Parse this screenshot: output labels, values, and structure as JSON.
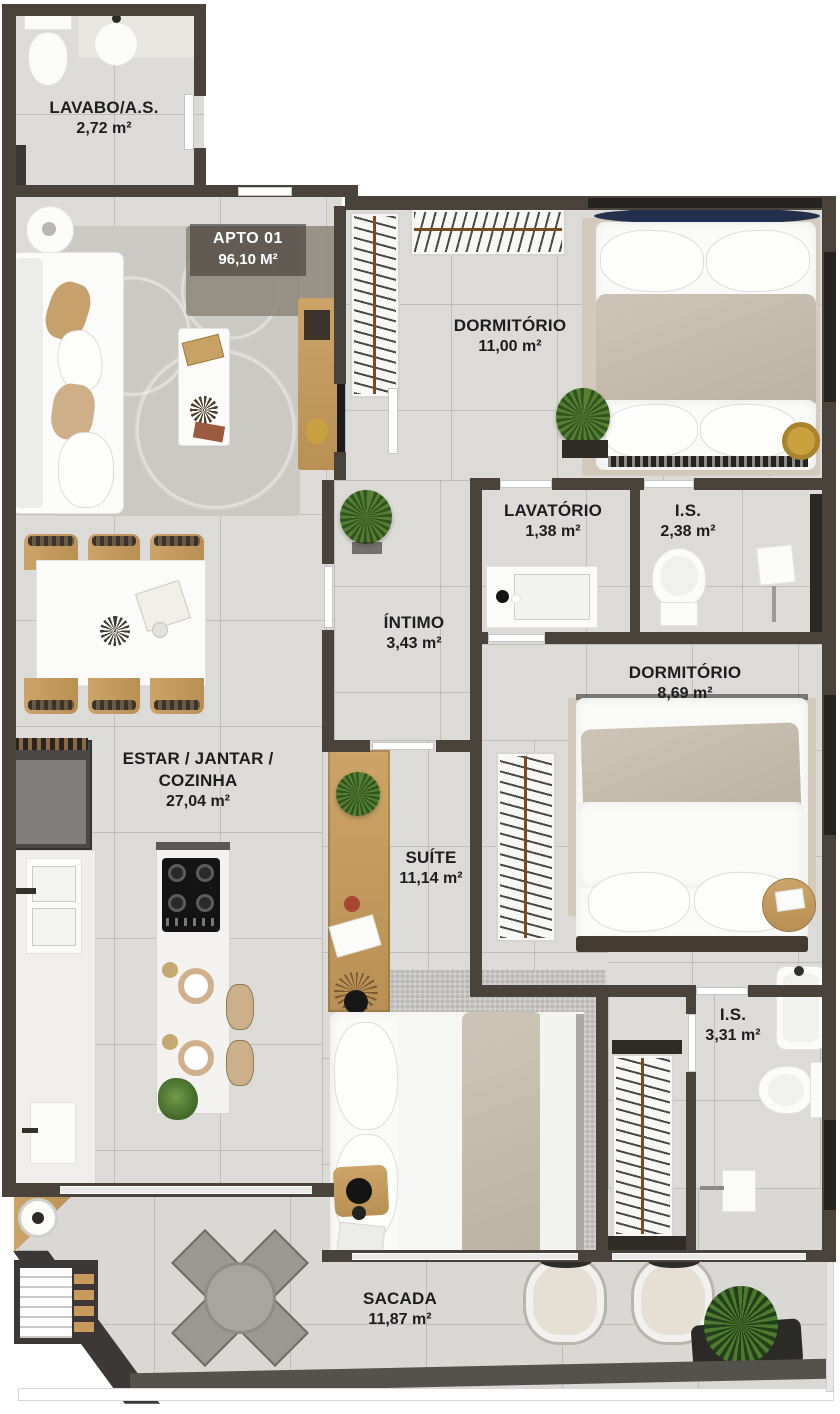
{
  "plan": {
    "apto": {
      "label": "APTO 01",
      "area": "96,10 M²"
    },
    "rooms": {
      "lavabo": {
        "name": "LAVABO/A.S.",
        "area": "2,72 m²"
      },
      "dormitorio1": {
        "name": "DORMITÓRIO",
        "area": "11,00 m²"
      },
      "lavatorio": {
        "name": "LAVATÓRIO",
        "area": "1,38 m²"
      },
      "is1": {
        "name": "I.S.",
        "area": "2,38 m²"
      },
      "intimo": {
        "name": "ÍNTIMO",
        "area": "3,43 m²"
      },
      "dormitorio2": {
        "name": "DORMITÓRIO",
        "area": "8,69 m²"
      },
      "estar": {
        "name_line1": "ESTAR / JANTAR /",
        "name_line2": "COZINHA",
        "area": "27,04 m²"
      },
      "suite": {
        "name": "SUÍTE",
        "area": "11,14 m²"
      },
      "is2": {
        "name": "I.S.",
        "area": "3,31 m²"
      },
      "sacada": {
        "name": "SACADA",
        "area": "11,87 m²"
      }
    },
    "colors": {
      "wall": "#49433b",
      "floor": "#dcdbd8",
      "wood": "#c49a5f",
      "blanket_beige": "#c7bdae",
      "headboard_navy": "#232f4e",
      "label_text": "#1d1d1f",
      "plant_green": "#47702c"
    }
  }
}
